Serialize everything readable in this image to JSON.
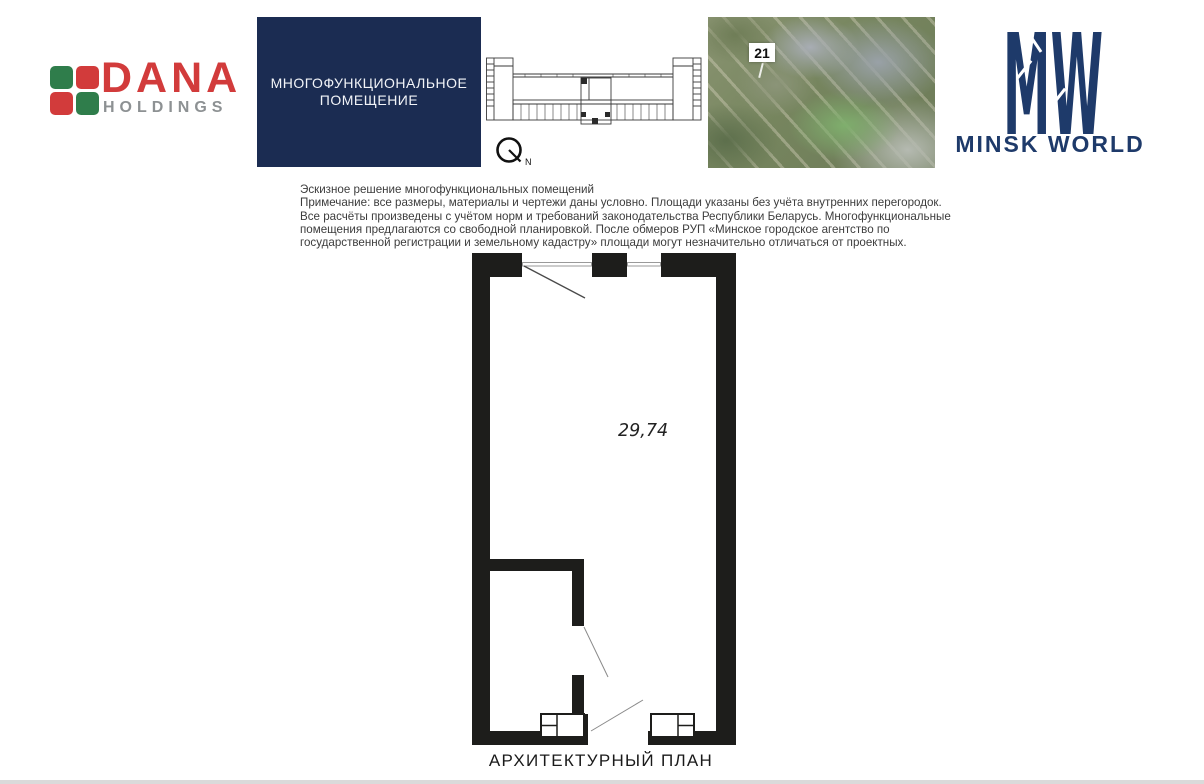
{
  "header": {
    "dana_logo": {
      "title": "DANA",
      "subtitle": "HOLDINGS",
      "red": "#d23b3b",
      "green": "#2f7d4b",
      "gray": "#8d9193"
    },
    "unit_banner": {
      "line1": "МНОГОФУНКЦИОНАЛЬНОЕ",
      "line2": "ПОМЕЩЕНИЕ",
      "background": "#1b2c52"
    },
    "compass": {
      "north_label": "N"
    },
    "aerial_photo": {
      "building_number": "21"
    },
    "minsk_world_logo": {
      "monogram_m": "M",
      "monogram_w": "W",
      "name": "MINSK WORLD",
      "navy": "#1e3a6a"
    }
  },
  "disclaimer": {
    "lines": [
      "Эскизное решение многофункциональных помещений",
      "Примечание: все размеры, материалы и чертежи даны условно. Площади указаны без учёта внутренних перегородок.",
      "Все расчёты произведены с учётом норм и требований законодательства Республики Беларусь. Многофункциональные",
      "помещения предлагаются со свободной планировкой. После обмеров РУП «Минское городское агентство по",
      "государственной регистрации и земельному кадастру» площади могут незначительно отличаться от проектных."
    ]
  },
  "floor_plan": {
    "area_label": "29,74",
    "caption": "АРХИТЕКТУРНЫЙ ПЛАН"
  }
}
